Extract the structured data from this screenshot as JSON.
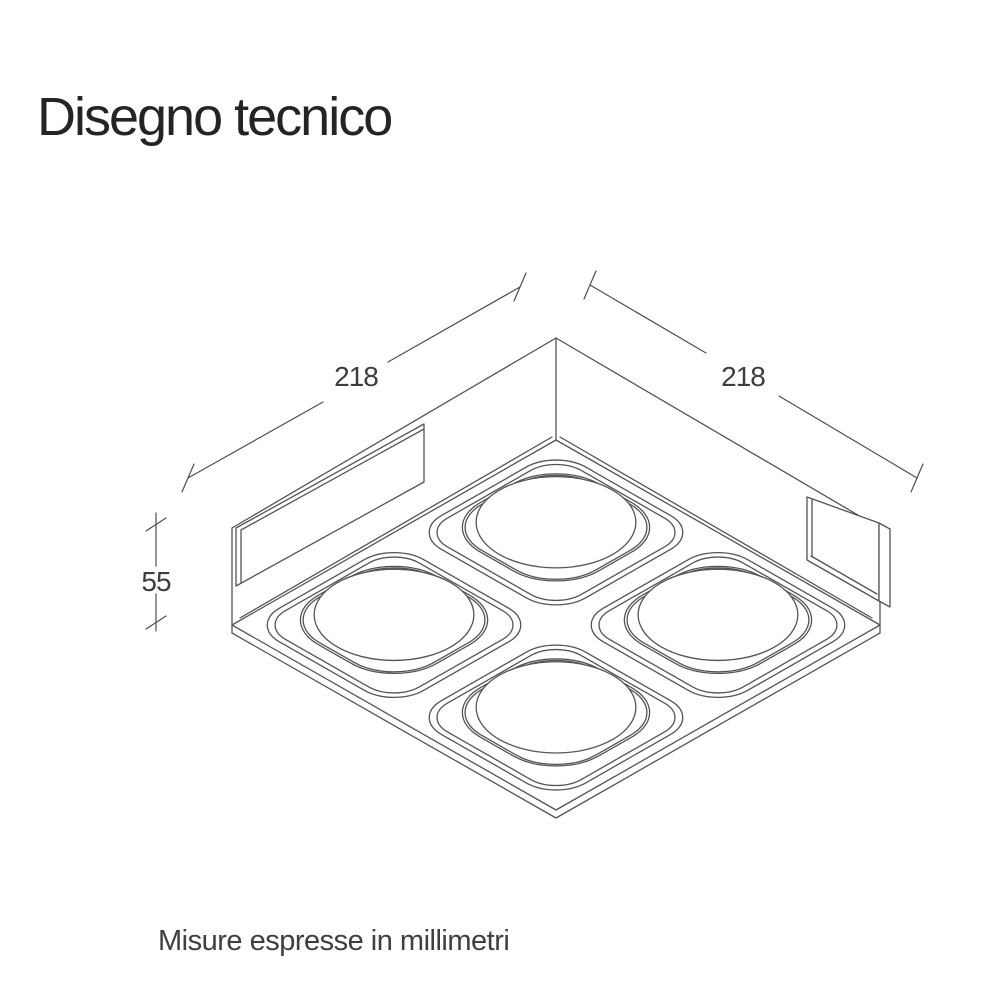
{
  "page": {
    "background_color": "#ffffff"
  },
  "title": "Disegno tecnico",
  "drawing": {
    "subject": "square-four-spot-ceiling-lamp-isometric-view",
    "line_color": "#545454",
    "label_color": "#3d3d3d",
    "dimensions": {
      "width_left": "218",
      "width_right": "218",
      "height": "55"
    }
  },
  "footer": "Misure espresse in millimetri"
}
